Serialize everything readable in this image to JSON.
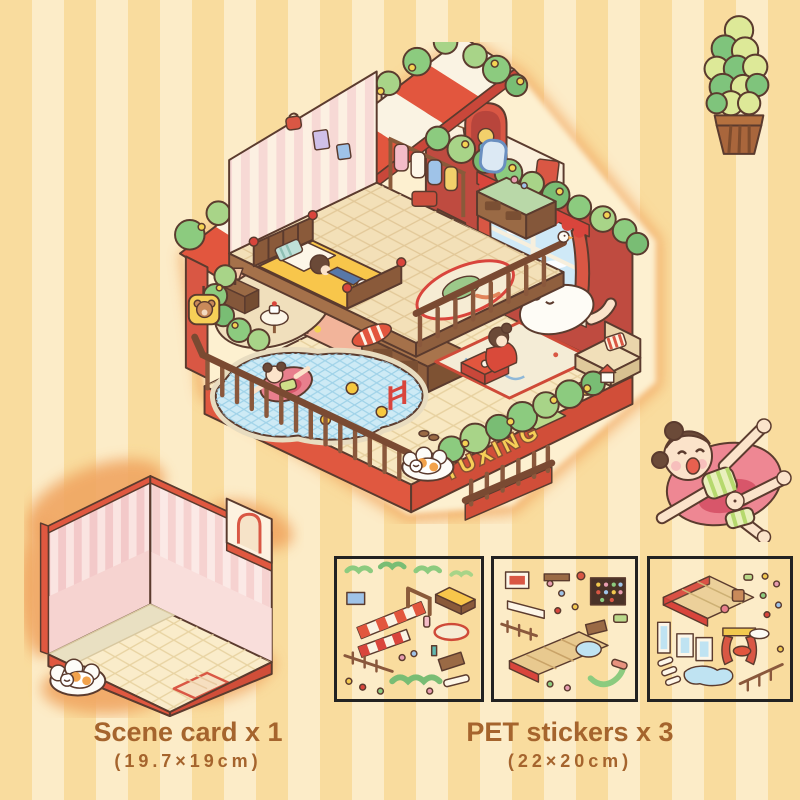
{
  "palette": {
    "stripe_dark": "#f9dc9e",
    "stripe_light": "#fcecc8",
    "accent_red": "#e2563e",
    "deep_red": "#c9473a",
    "hedge_green": "#8ccb7f",
    "text_brown": "#a5642d",
    "wall_pink": "#f6d7d6",
    "floor_cream": "#f8e8c2",
    "pool_blue": "#cdeaf5",
    "wood_brown": "#7a4a32",
    "sign_yellow": "#f6cf57",
    "sheet_border": "#222222"
  },
  "sign": {
    "text": "TUXING"
  },
  "captions": {
    "scene_card_label": "Scene card x 1",
    "scene_card_size": "(19.7×19cm)",
    "stickers_label": "PET stickers x 3",
    "stickers_size": "(22×20cm)"
  }
}
